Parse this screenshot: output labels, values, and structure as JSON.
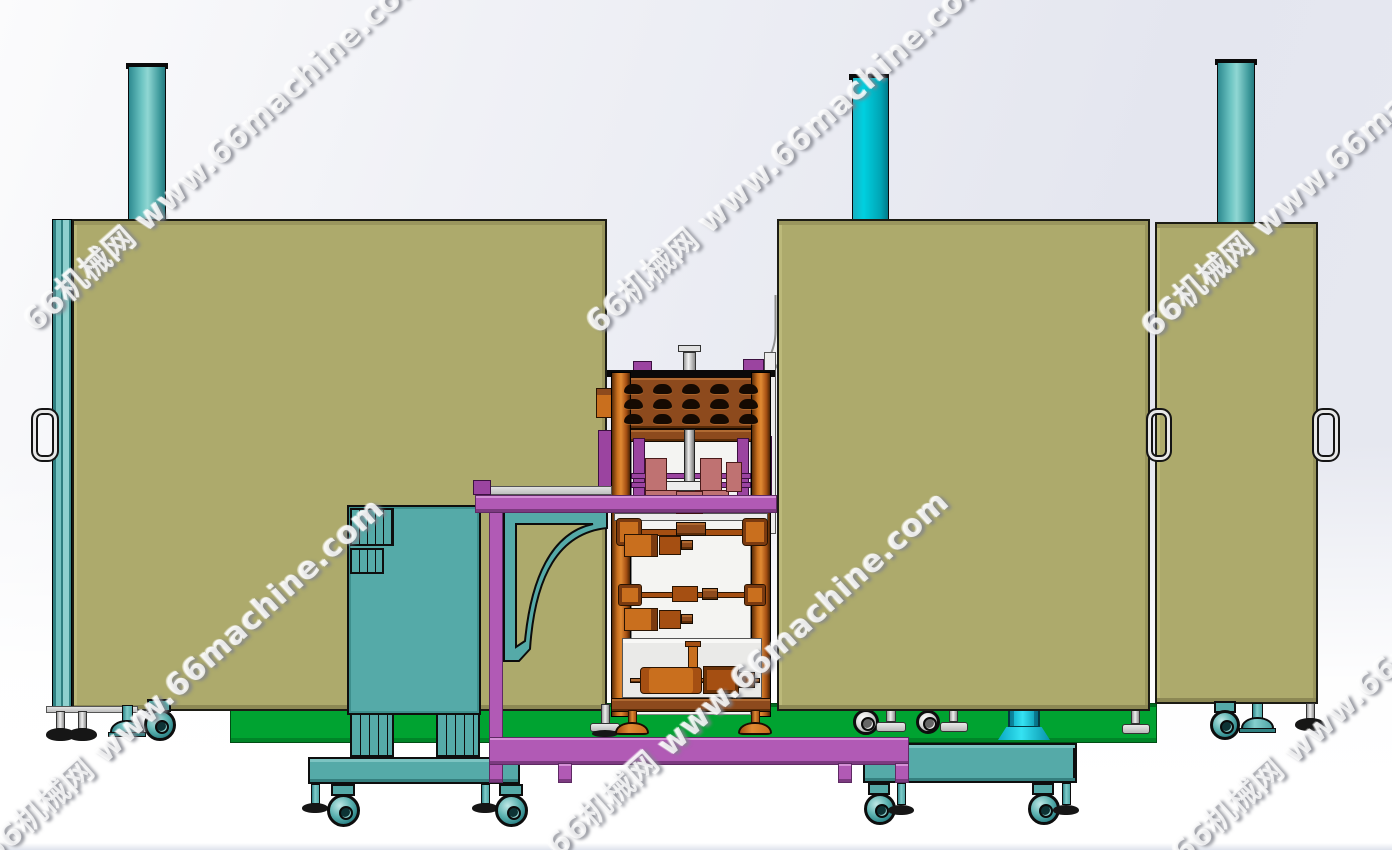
{
  "watermark": {
    "text": "66机械网 www.66machine.com"
  },
  "palette": {
    "background_top_right": "#e4e6ef",
    "background_bottom": "#ffffff",
    "enclosure_olive": "#adaa6c",
    "teal_structure": "#55aaa8",
    "chimney_soft_teal": "#6cc4c2",
    "chimney_bright_cyan": "#00d0e0",
    "green_platform": "#00a331",
    "purple_frame": "#b15ab5",
    "copper_column": "#c96f1e",
    "header_brown": "#8d4a1d",
    "salmon_fixture": "#bf7272",
    "bright_cyan_pump": "#35e2f2",
    "outline_black": "#0d0d0d"
  }
}
